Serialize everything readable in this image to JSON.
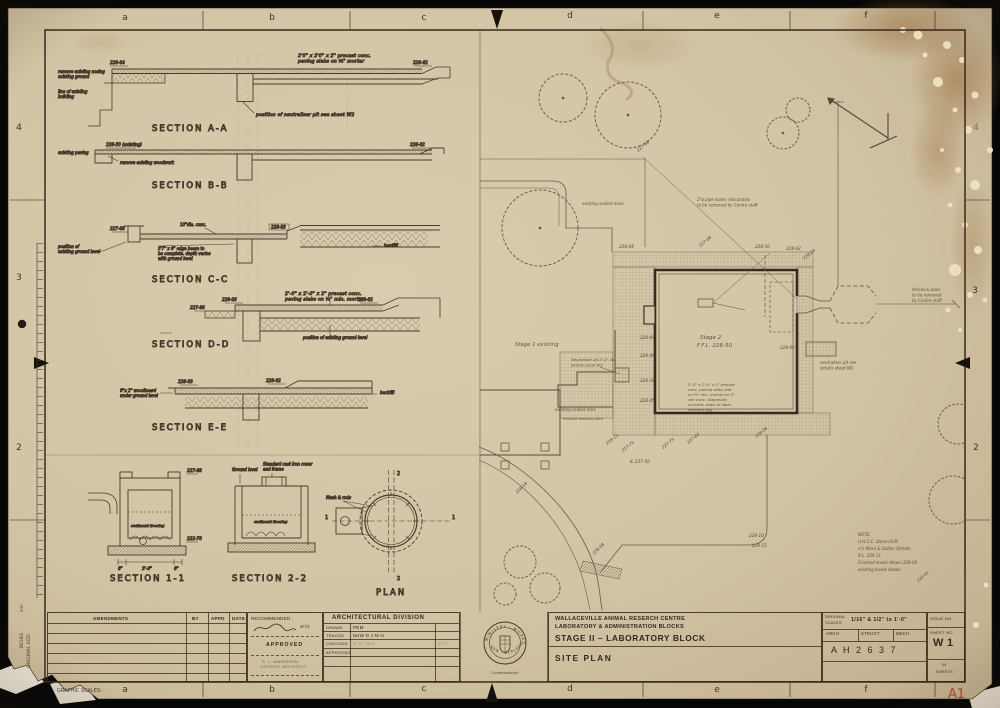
{
  "frame": {
    "top_letters": [
      "a",
      "b",
      "c",
      "d",
      "e",
      "f"
    ],
    "bottom_letters": [
      "a",
      "b",
      "c",
      "d",
      "e",
      "f"
    ],
    "left_numbers": [
      "4",
      "3",
      "2"
    ],
    "right_numbers": [
      "4",
      "3",
      "2"
    ],
    "corner_size": "A1",
    "graphic_scales": "GRAPHIC SCALES:",
    "original_size": "ORIGINAL SIZE",
    "units_mm": "mm",
    "units_inches": "INCHES"
  },
  "sections": {
    "aa": {
      "title": "SECTION  A-A",
      "level_left": "228-64",
      "level_right": "228-62",
      "note_paving1": "2'0\" x 2'0\" x 2\" precast conc.",
      "note_paving2": "paving slabs on ½\" mortar",
      "note_left1": "remove existing nosing",
      "note_left2": "existing ground",
      "note_left3": "line of existing",
      "note_left4": "building",
      "note_pit": "position of neutraliser pit see sheet W2"
    },
    "bb": {
      "title": "SECTION  B-B",
      "note_left": "existing paving",
      "level_left": "228-50 (existing)",
      "note_remove": "remove existing woodwork",
      "level_right": "228-62"
    },
    "cc": {
      "title": "SECTION C-C",
      "note_top": "10\"dia. conc.",
      "level_left": "227-68",
      "level_mid": "228-03",
      "note_beam1": "3'7\" x 6\" edge beam to",
      "note_beam2": "be complete. depth varies",
      "note_beam3": "with ground level",
      "note_ground1": "position of",
      "note_ground2": "existing ground level",
      "note_fill": "hardfill"
    },
    "dd": {
      "title": "SECTION D-D",
      "note_paving1": "2'-0\" x 2'-0\" x 2\" precast conc.",
      "note_paving2": "paving slabs on ½\" min. mortar",
      "level_a": "228-03",
      "level_b": "227-80",
      "level_c": "228-62",
      "note_ground": "position of existing ground level"
    },
    "ee": {
      "title": "SECTION  E-E",
      "level_a": "228-03",
      "level_b": "228-62",
      "note_board1": "6\"x 2\" woodboard",
      "note_board2": "under ground level",
      "note_fill": "backfill"
    },
    "s11": {
      "title": "SECTION  1-1",
      "level_top": "227-68",
      "level_bottom": "222-76",
      "note_floor": "sediment flooring",
      "dim_left": "6\"",
      "dim_mid": "3'-6\"",
      "dim_right": "6\""
    },
    "s22": {
      "title": "SECTION  2-2",
      "note_ground": "Ground level",
      "note_cover1": "Standard cast iron cover",
      "note_cover2": "and frame",
      "note_floor": "sediment flooring"
    },
    "plan": {
      "title": "PLAN",
      "note_rods": "Mesh & rods",
      "cut_top": "2",
      "cut_bottom": "2",
      "cut_left": "1",
      "cut_right": "1"
    }
  },
  "site": {
    "stage2_label": "Stage  2",
    "stage2_ffl": "F.F.L.  228-50",
    "stage1_label": "Stage 1   existing",
    "pipe_note1": "2\"ø pipe water reticulation",
    "pipe_note2": "to be  removed  by Centre staff",
    "fence_note1": "fences & pens",
    "fence_note2": "to  be  removed",
    "fence_note3": "by Centre staff",
    "neut_note1": "neutraliser pit see",
    "neut_note2": "details sheet W2",
    "neut2_note1": "Neutraliser pit 2'-0\" dia.",
    "neut2_note2": "details sheet W2",
    "drive_label": "existing sealed drive",
    "area_label": "existing sealed area",
    "kerb_label": "remove existing kerb",
    "paving_note": [
      "2'-0\" x 2'-0\" x 2\" precast",
      "conc. paving slabs laid",
      "on ½\" min. mortar on 3\"",
      "site conc. diagonally",
      "coursed. slabs to have",
      "exposed agg."
    ],
    "note_block": [
      "NOTE:",
      "U.H.C.C.  datum  B.M.",
      "crn Ward & Dalton Streets",
      "R.L.  229-11",
      "Finished levels shown   228-04",
      "existing levels shown"
    ],
    "note_diag": "220-04",
    "levels": [
      "228-04",
      "227-68",
      "228-62",
      "227-68",
      "228-41",
      "228-46",
      "228-38",
      "228-05",
      "228-06",
      "228-15",
      "227-75",
      "IL 227-50",
      "227-75",
      "227-84",
      "228-08",
      "228-10",
      "228-15",
      "228-18",
      "228-08",
      "228-04",
      "228-50"
    ]
  },
  "title_block": {
    "amendments": {
      "header": "AMENDMENTS",
      "by": "BY",
      "appd": "APPD",
      "date": "DATE"
    },
    "recommended": {
      "label": "RECOMMENDED :",
      "sig_date": "4/71",
      "approved": "APPROVED",
      "name": "R. L. ANDERSON",
      "role": "DISTRICT ARCHITECT"
    },
    "division": {
      "header": "ARCHITECTURAL  DIVISION",
      "rows": [
        {
          "label": "DRAWN",
          "value": "PEM",
          "extra": ""
        },
        {
          "label": "TRACED",
          "value": "MJW   D J M H",
          "extra": ""
        },
        {
          "label": "CHECKED",
          "value": "P. E. Mon",
          "extra": "9/71"
        },
        {
          "label": "APPROVED",
          "value": "",
          "extra": ""
        }
      ]
    },
    "seal": {
      "arc_top": "MINISTRY · WORKS",
      "arc_bottom": "NEW · ZEALAND",
      "caption": "Commissioner"
    },
    "project": {
      "line1": "WALLACEVILLE   ANIMAL   RESERCH   CENTRE",
      "line2": "LABORATORY   &   ADMINISTRATION   BLOCKS",
      "line3": "STAGE  II  –  LABORATORY  BLOCK",
      "drawing_title": "SITE   PLAN"
    },
    "scales": {
      "label1": "ORIGINAL",
      "label2": "SCALES",
      "value": "1/16\" & 1/2\" to 1'-0\"",
      "arch": "ARCH",
      "struct": "STRUCT",
      "mech": "MECH",
      "job_no": "A H 2 6 3 7"
    },
    "issue": {
      "issue_label": "ISSUE NO:",
      "sheet_label": "SHEET NO",
      "sheet_no": "W 1",
      "in_word": "IN",
      "sheets_word": "SHEETS"
    }
  }
}
